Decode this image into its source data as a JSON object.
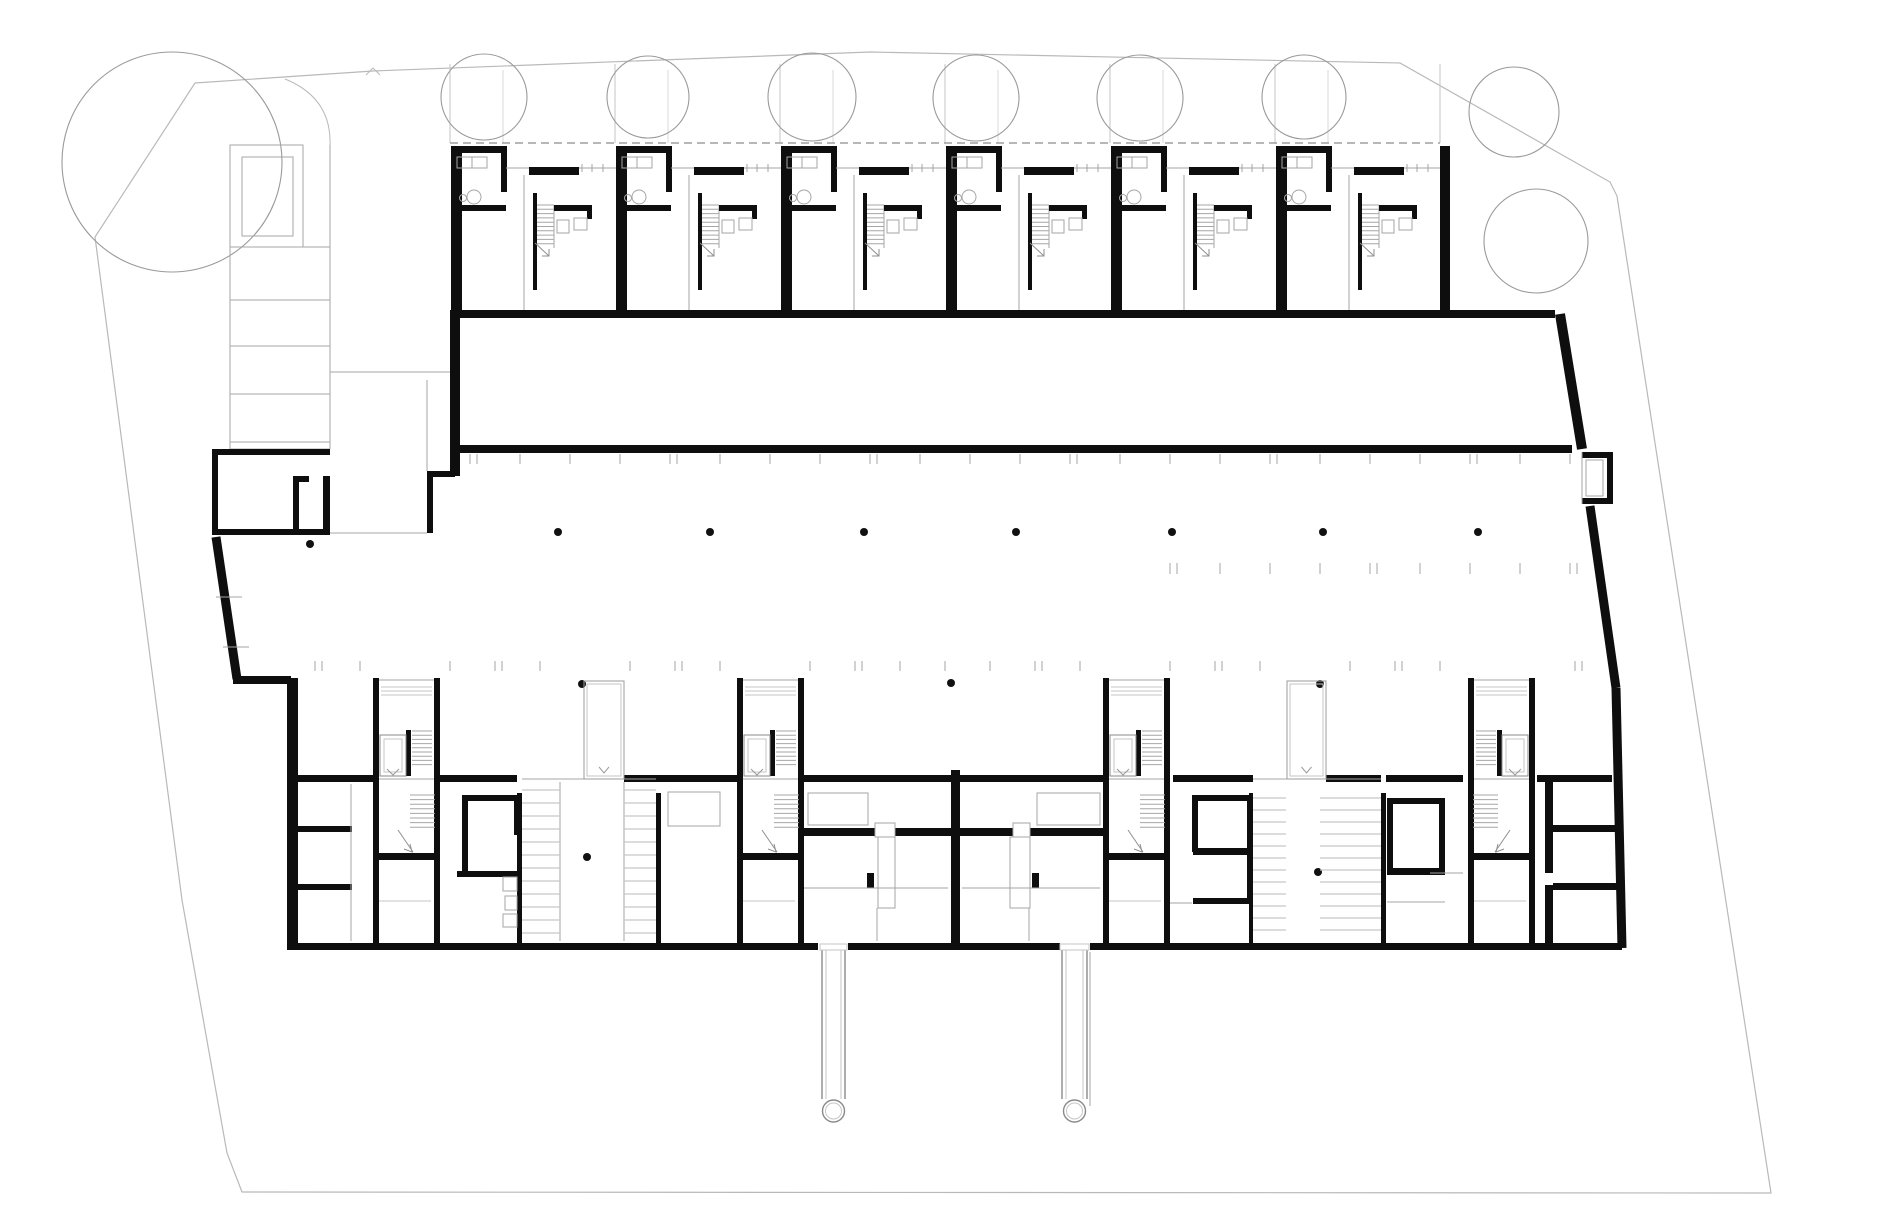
{
  "document": {
    "type": "architectural-floor-plan",
    "subject": "ground floor site plan with townhouse row, driveway, parking court and lower apartment block",
    "width": 1880,
    "height": 1230
  },
  "palette": {
    "paper": "#ffffff",
    "wall": "#0e0e0e",
    "thin": "#a6a6a6",
    "lighter": "#c6c6c6",
    "site": "#b9b9b9",
    "tree": "#9a9a9a",
    "dot": "#111111",
    "dash": "#9f9f9f"
  },
  "site": {
    "boundary": [
      [
        195,
        83
      ],
      [
        373,
        71
      ],
      [
        870,
        52
      ],
      [
        1400,
        63
      ],
      [
        1610,
        182
      ],
      [
        1617,
        196
      ],
      [
        1653,
        430
      ],
      [
        1748,
        1044
      ],
      [
        1771,
        1193
      ],
      [
        242,
        1192
      ],
      [
        227,
        1153
      ],
      [
        182,
        900
      ],
      [
        95,
        237
      ],
      [
        195,
        83
      ]
    ],
    "caret": [
      [
        366,
        75
      ],
      [
        373,
        68
      ],
      [
        380,
        75
      ]
    ]
  },
  "trees": {
    "large": {
      "cx": 172,
      "cy": 162,
      "r": 110
    },
    "row": [
      {
        "cx": 484,
        "cy": 97,
        "r": 43
      },
      {
        "cx": 648,
        "cy": 97,
        "r": 41
      },
      {
        "cx": 812,
        "cy": 97,
        "r": 44
      },
      {
        "cx": 976,
        "cy": 98,
        "r": 43
      },
      {
        "cx": 1140,
        "cy": 98,
        "r": 43
      },
      {
        "cx": 1304,
        "cy": 97,
        "r": 42
      }
    ],
    "right": [
      {
        "cx": 1514,
        "cy": 112,
        "r": 45
      },
      {
        "cx": 1536,
        "cy": 241,
        "r": 52
      }
    ]
  },
  "garden": {
    "dividers_x": [
      450,
      615,
      780,
      945,
      1110,
      1275,
      1440
    ],
    "sub_dividers_x": [
      503,
      668,
      833,
      998,
      1163,
      1328
    ],
    "top_y": 64,
    "bottom_y": 143,
    "arc": "M 285,79 Q 332,98 330,146",
    "dashed": {
      "x1": 450,
      "x2": 1440,
      "y": 143
    }
  },
  "townhouses": {
    "origin_x": 451,
    "module_w": 165,
    "count": 6,
    "top_y": 146,
    "bottom_y": 317,
    "right_wall": [
      1440,
      146,
      10,
      171
    ]
  },
  "ramp": {
    "lane_x1": 230,
    "lane_x2": 330,
    "top": 145,
    "bottom": 449,
    "enclosure": [
      230,
      145,
      73,
      102
    ],
    "inner": [
      242,
      157,
      51,
      79
    ],
    "rungs": [
      247,
      300,
      346,
      394,
      442
    ]
  },
  "west_room_walls": [
    [
      212,
      449,
      118,
      6
    ],
    [
      212,
      449,
      6,
      86
    ],
    [
      212,
      529,
      118,
      6
    ],
    [
      323,
      476,
      7,
      59
    ],
    [
      293,
      476,
      6,
      59
    ],
    [
      293,
      476,
      16,
      6
    ],
    [
      427,
      471,
      28,
      6
    ],
    [
      427,
      477,
      6,
      56
    ]
  ],
  "driveway": {
    "top_wall": [
      450,
      310,
      1105,
      8
    ],
    "bottom_wall": [
      456,
      445,
      1116,
      8
    ],
    "left_wall": [
      450,
      317,
      10,
      159
    ],
    "slants": [
      [
        1560,
        314,
        1582,
        449,
        10
      ],
      [
        1590,
        506,
        1616,
        688,
        9
      ],
      [
        1616,
        688,
        1622,
        948,
        9
      ]
    ],
    "end_box": {
      "walls": [
        [
          1582,
          452,
          31,
          6
        ],
        [
          1607,
          452,
          6,
          52
        ],
        [
          1582,
          498,
          31,
          6
        ]
      ],
      "inner": [
        1586,
        460,
        17,
        36
      ],
      "left_edge": [
        1582,
        452,
        1582,
        504
      ]
    }
  },
  "parking": {
    "row_a": {
      "y1": 454,
      "y2": 464,
      "x0": 470,
      "x1": 1570,
      "step": 50
    },
    "row_b": {
      "y1": 563,
      "y2": 574,
      "x0": 1170,
      "x1": 1570,
      "step": 50
    },
    "row_c": {
      "y1": 661,
      "y2": 671,
      "x0": 315,
      "x1": 1600,
      "step": 45,
      "skip": [
        [
          373,
          440
        ],
        [
          737,
          804
        ],
        [
          1103,
          1170
        ],
        [
          1468,
          1537
        ],
        [
          578,
          630
        ],
        [
          1281,
          1332
        ]
      ]
    },
    "left_slant": [
      216,
      537,
      237,
      679
    ],
    "left_jog": [
      233,
      676,
      58,
      8
    ],
    "stall_dashes": [
      [
        216,
        597,
        242,
        597
      ],
      [
        223,
        647,
        249,
        647
      ]
    ],
    "dots": [
      [
        558,
        532
      ],
      [
        710,
        532
      ],
      [
        864,
        532
      ],
      [
        1016,
        532
      ],
      [
        1172,
        532
      ],
      [
        1323,
        532
      ],
      [
        1478,
        532
      ],
      [
        310,
        544
      ],
      [
        951,
        683
      ],
      [
        582,
        684
      ],
      [
        1320,
        684
      ],
      [
        587,
        857
      ],
      [
        1318,
        872
      ]
    ],
    "dot_r": 4
  },
  "lower_band": {
    "left_wall": [
      287,
      678,
      11,
      272
    ],
    "top_wall_y": 775,
    "top_wall_h": 7,
    "top_wall_segments": [
      [
        298,
        75
      ],
      [
        440,
        77
      ],
      [
        624,
        113
      ],
      [
        801,
        302
      ],
      [
        1173,
        80
      ],
      [
        1326,
        55
      ],
      [
        1386,
        77
      ],
      [
        1537,
        75
      ]
    ],
    "bottom_wall_y": 943,
    "bottom_wall_h": 7,
    "bottom_wall_segments": [
      [
        287,
        531
      ],
      [
        848,
        212
      ],
      [
        1090,
        532
      ]
    ],
    "walls": [
      [
        290,
        826,
        62,
        6
      ],
      [
        290,
        884,
        62,
        6
      ],
      [
        462,
        795,
        58,
        6
      ],
      [
        462,
        795,
        6,
        82
      ],
      [
        457,
        871,
        63,
        6
      ],
      [
        514,
        795,
        6,
        40
      ],
      [
        517,
        793,
        5,
        152
      ],
      [
        656,
        793,
        5,
        152
      ],
      [
        1249,
        793,
        4,
        152
      ],
      [
        1381,
        793,
        5,
        152
      ],
      [
        951,
        770,
        9,
        173
      ],
      [
        803,
        828,
        72,
        8
      ],
      [
        895,
        828,
        118,
        8
      ],
      [
        1030,
        828,
        73,
        8
      ],
      [
        867,
        873,
        7,
        15
      ],
      [
        1032,
        873,
        7,
        15
      ],
      [
        1192,
        795,
        60,
        6
      ],
      [
        1192,
        795,
        6,
        57
      ],
      [
        1247,
        795,
        6,
        108
      ],
      [
        1193,
        848,
        57,
        7
      ],
      [
        1193,
        898,
        57,
        6
      ],
      [
        1387,
        798,
        58,
        6
      ],
      [
        1387,
        798,
        6,
        77
      ],
      [
        1439,
        798,
        6,
        77
      ],
      [
        1387,
        868,
        58,
        7
      ],
      [
        1545,
        782,
        8,
        91
      ],
      [
        1545,
        885,
        8,
        60
      ],
      [
        1553,
        825,
        64,
        7
      ],
      [
        1553,
        883,
        64,
        7
      ]
    ],
    "gray_rects": [
      [
        503,
        877,
        14,
        14
      ],
      [
        505,
        896,
        12,
        14
      ],
      [
        503,
        914,
        14,
        13
      ],
      [
        668,
        792,
        52,
        34
      ],
      [
        808,
        793,
        60,
        32
      ],
      [
        1037,
        793,
        63,
        32
      ],
      [
        878,
        837,
        17,
        71
      ],
      [
        1010,
        837,
        20,
        71
      ],
      [
        875,
        823,
        20,
        14
      ],
      [
        1013,
        823,
        17,
        14
      ]
    ],
    "gray_lines": [
      [
        351,
        784,
        351,
        941
      ],
      [
        330,
        533,
        427,
        533
      ],
      [
        427,
        380,
        427,
        471
      ],
      [
        330,
        372,
        450,
        372
      ],
      [
        560,
        782,
        560,
        941
      ],
      [
        624,
        782,
        624,
        941
      ],
      [
        803,
        888,
        948,
        888
      ],
      [
        962,
        888,
        1100,
        888
      ],
      [
        877,
        908,
        877,
        941
      ],
      [
        1029,
        908,
        1029,
        941
      ],
      [
        1168,
        903,
        1192,
        903
      ],
      [
        1387,
        902,
        1445,
        902
      ],
      [
        1430,
        873,
        1463,
        873
      ],
      [
        522,
        779,
        656,
        779
      ],
      [
        1253,
        779,
        1381,
        779
      ],
      [
        1090,
        952,
        1090,
        1106
      ]
    ],
    "stripes": [
      {
        "x": 522,
        "w": 38,
        "y": 790,
        "n": 12,
        "dy": 13
      },
      {
        "x": 624,
        "w": 32,
        "y": 790,
        "n": 12,
        "dy": 13
      },
      {
        "x": 1253,
        "w": 33,
        "y": 798,
        "n": 12,
        "dy": 12
      },
      {
        "x": 1320,
        "w": 61,
        "y": 798,
        "n": 12,
        "dy": 12
      }
    ],
    "cores": {
      "xs": [
        373,
        737,
        1103,
        1468
      ],
      "mirrored": [
        false,
        false,
        false,
        true
      ],
      "w": 67,
      "top": 678,
      "bottom": 943,
      "cross_y": 853
    },
    "shafts": [
      {
        "x": 584,
        "y": 681,
        "w": 40,
        "h": 98
      },
      {
        "x": 1287,
        "y": 681,
        "w": 39,
        "h": 98
      }
    ],
    "tubes": {
      "items": [
        {
          "x": 822,
          "w": 23
        },
        {
          "x": 1062,
          "w": 25
        }
      ],
      "y0": 950,
      "y1": 1099,
      "cy": 1111,
      "r": 11,
      "wall_gap_rects": [
        [
          820,
          944,
          27,
          6
        ],
        [
          1060,
          944,
          29,
          6
        ]
      ]
    }
  }
}
